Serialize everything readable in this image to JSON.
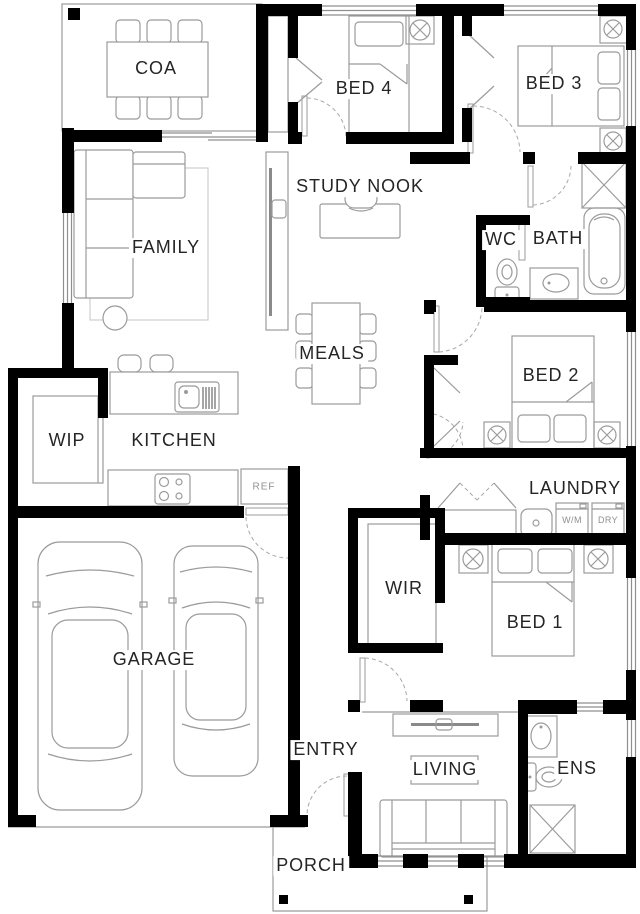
{
  "plan": {
    "colors": {
      "background": "#ffffff",
      "walls": "#000000",
      "furniture_lines": "#9b9b9b",
      "label_text": "#252525",
      "small_label_text": "#8f8f8f"
    },
    "rooms": [
      {
        "id": "alfresco",
        "label": "COA"
      },
      {
        "id": "bed4",
        "label": "BED 4"
      },
      {
        "id": "bed3",
        "label": "BED 3"
      },
      {
        "id": "study-nook",
        "label": "STUDY NOOK"
      },
      {
        "id": "family",
        "label": "FAMILY"
      },
      {
        "id": "wc",
        "label": "WC"
      },
      {
        "id": "bath",
        "label": "BATH"
      },
      {
        "id": "meals",
        "label": "MEALS"
      },
      {
        "id": "bed2",
        "label": "BED 2"
      },
      {
        "id": "wip",
        "label": "WIP"
      },
      {
        "id": "kitchen",
        "label": "KITCHEN"
      },
      {
        "id": "laundry",
        "label": "LAUNDRY"
      },
      {
        "id": "garage",
        "label": "GARAGE"
      },
      {
        "id": "wir",
        "label": "WIR"
      },
      {
        "id": "bed1",
        "label": "BED 1"
      },
      {
        "id": "entry",
        "label": "ENTRY"
      },
      {
        "id": "living",
        "label": "LIVING"
      },
      {
        "id": "ens",
        "label": "ENS"
      },
      {
        "id": "porch",
        "label": "PORCH"
      }
    ],
    "appliances": {
      "fridge_label": "REF",
      "washer_label": "W/M",
      "dryer_label": "DRY"
    }
  }
}
